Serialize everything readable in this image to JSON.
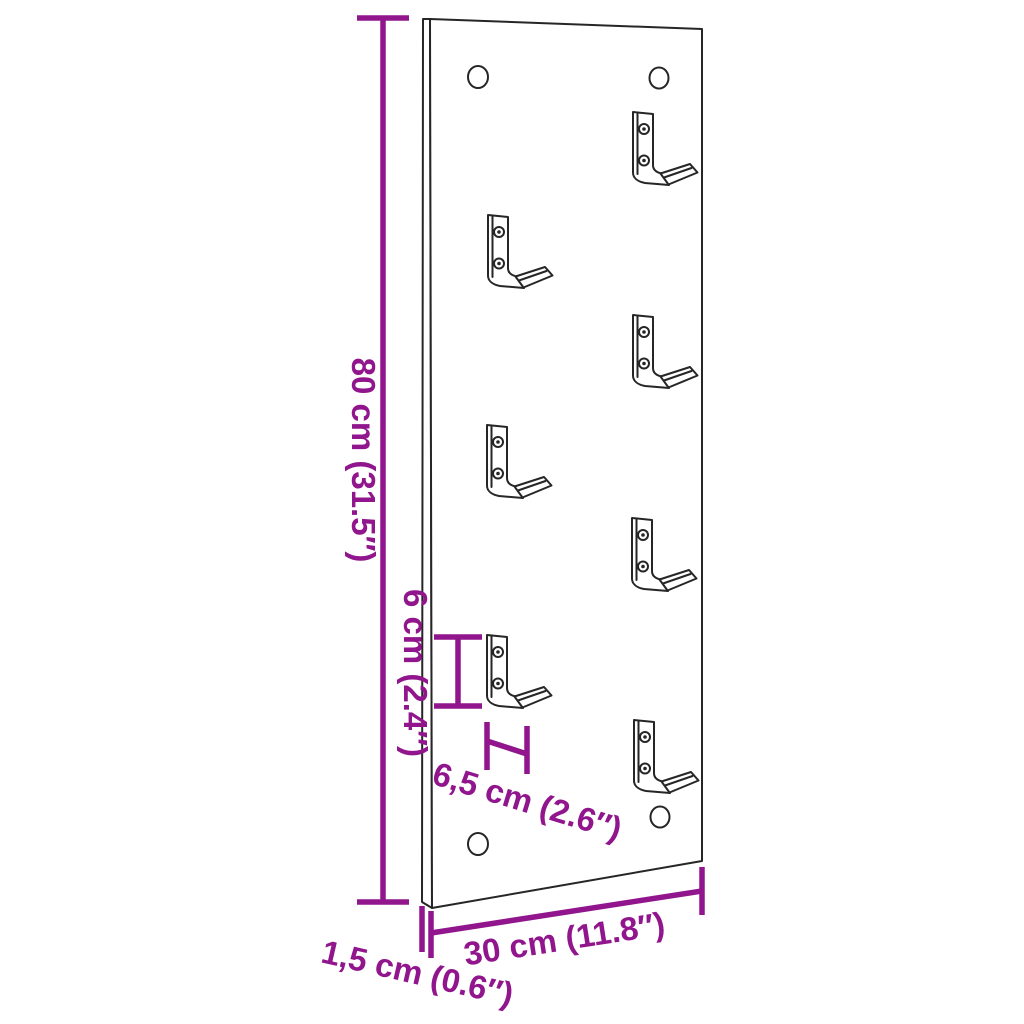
{
  "diagram": {
    "kind": "product-dimension-diagram",
    "product": "wall-mounted hook rack panel",
    "hooks_count": 7,
    "mounting_holes_count": 4
  },
  "colors": {
    "dimension_accent": "#91158C",
    "outline": "#262626",
    "background": "#FFFFFF"
  },
  "dimensions": {
    "height_label": "80 cm (31.5″)",
    "hook_height_label": "6 cm (2.4″)",
    "hook_depth_label": "6,5 cm (2.6″)",
    "width_label": "30 cm (11.8″)",
    "thickness_label": "1,5 cm (0.6″)"
  }
}
